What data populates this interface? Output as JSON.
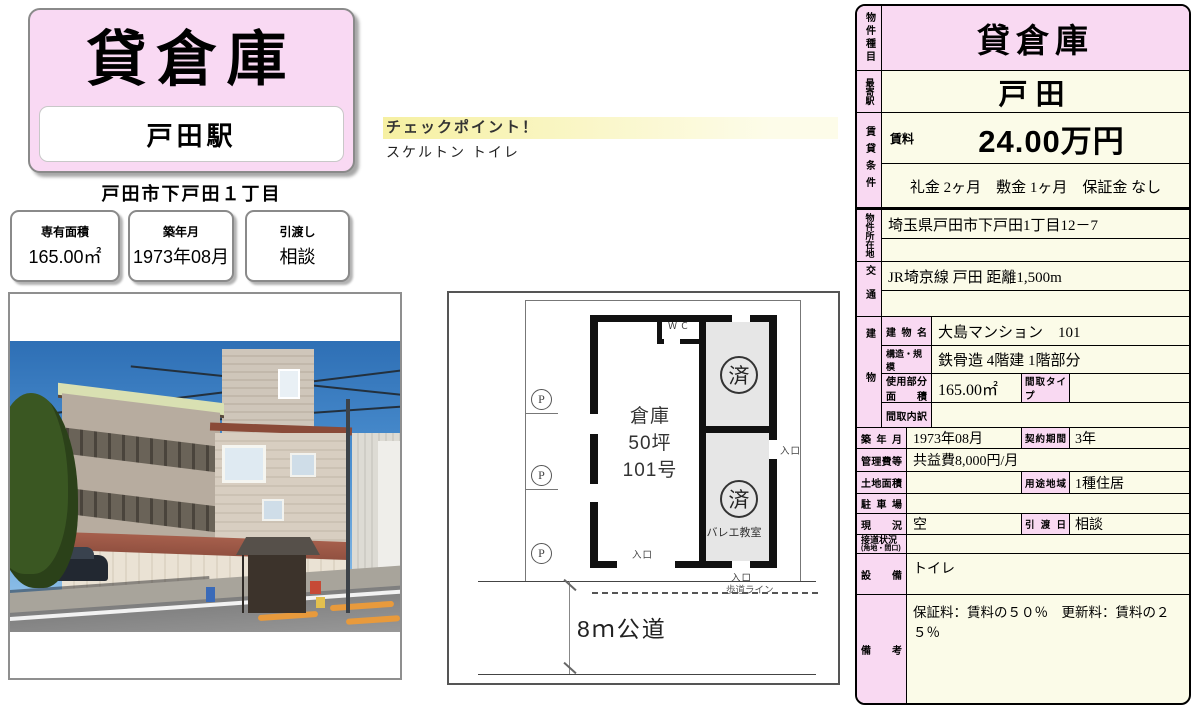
{
  "header": {
    "title": "貸倉庫",
    "station": "戸田駅",
    "address": "戸田市下戸田１丁目",
    "info_boxes": [
      {
        "label": "専有面積",
        "value": "165.00㎡"
      },
      {
        "label": "築年月",
        "value": "1973年08月"
      },
      {
        "label": "引渡し",
        "value": "相談"
      }
    ],
    "checkpoint": {
      "title": "チェックポイント！",
      "note": "スケルトン トイレ"
    }
  },
  "floor_plan": {
    "room_line1": "倉庫",
    "room_line2": "50坪",
    "room_line3": "101号",
    "wc": "ＷＣ",
    "occupied_mark": "済",
    "ballet": "バレエ教室",
    "entrance": "入口",
    "parking": "P",
    "sidewalk_line": "歩道ライン",
    "road": "8ｍ公道"
  },
  "table": {
    "property_type": {
      "label": "物件種目",
      "value": "貸倉庫"
    },
    "station": {
      "label": "最寄駅",
      "value": "戸田"
    },
    "rent": {
      "label": "賃貸条件",
      "rent_label": "賃料",
      "rent_value": "24.00万円",
      "terms": "礼金 2ヶ月　敷金 1ヶ月　保証金 なし"
    },
    "location": {
      "label": "物件所在地",
      "value": "埼玉県戸田市下戸田1丁目12－7",
      "value2": ""
    },
    "transport": {
      "label": "交通",
      "value": "JR埼京線 戸田 距離1,500m",
      "value2": ""
    },
    "building": {
      "label": "建物",
      "name": {
        "label": "建物名",
        "value": "大島マンション　101"
      },
      "structure": {
        "label": "構造・規模",
        "value": "鉄骨造 4階建 1階部分"
      },
      "area": {
        "label_line1": "使用部分",
        "label_line2": "面積",
        "value": "165.00㎡",
        "sub_label": "間取タイプ",
        "sub_value": ""
      },
      "layout": {
        "label": "間取内訳",
        "value": ""
      }
    },
    "built": {
      "label": "築年月",
      "value": "1973年08月",
      "sub_label": "契約期間",
      "sub_value": "3年"
    },
    "fees": {
      "label": "管理費等",
      "value": "共益費8,000円/月"
    },
    "land": {
      "label": "土地面積",
      "value": "",
      "sub_label": "用途地域",
      "sub_value": "1種住居"
    },
    "parking": {
      "label": "駐車場",
      "value": ""
    },
    "status": {
      "label": "現況",
      "value": "空",
      "sub_label": "引渡日",
      "sub_value": "相談"
    },
    "road_access": {
      "label": "接道状況",
      "label2": "(角地・間口)",
      "value": ""
    },
    "equipment": {
      "label": "設備",
      "value": "トイレ"
    },
    "remarks": {
      "label": "備考",
      "value": "保証料：賃料の５０％　更新料：賃料の２５％"
    }
  }
}
